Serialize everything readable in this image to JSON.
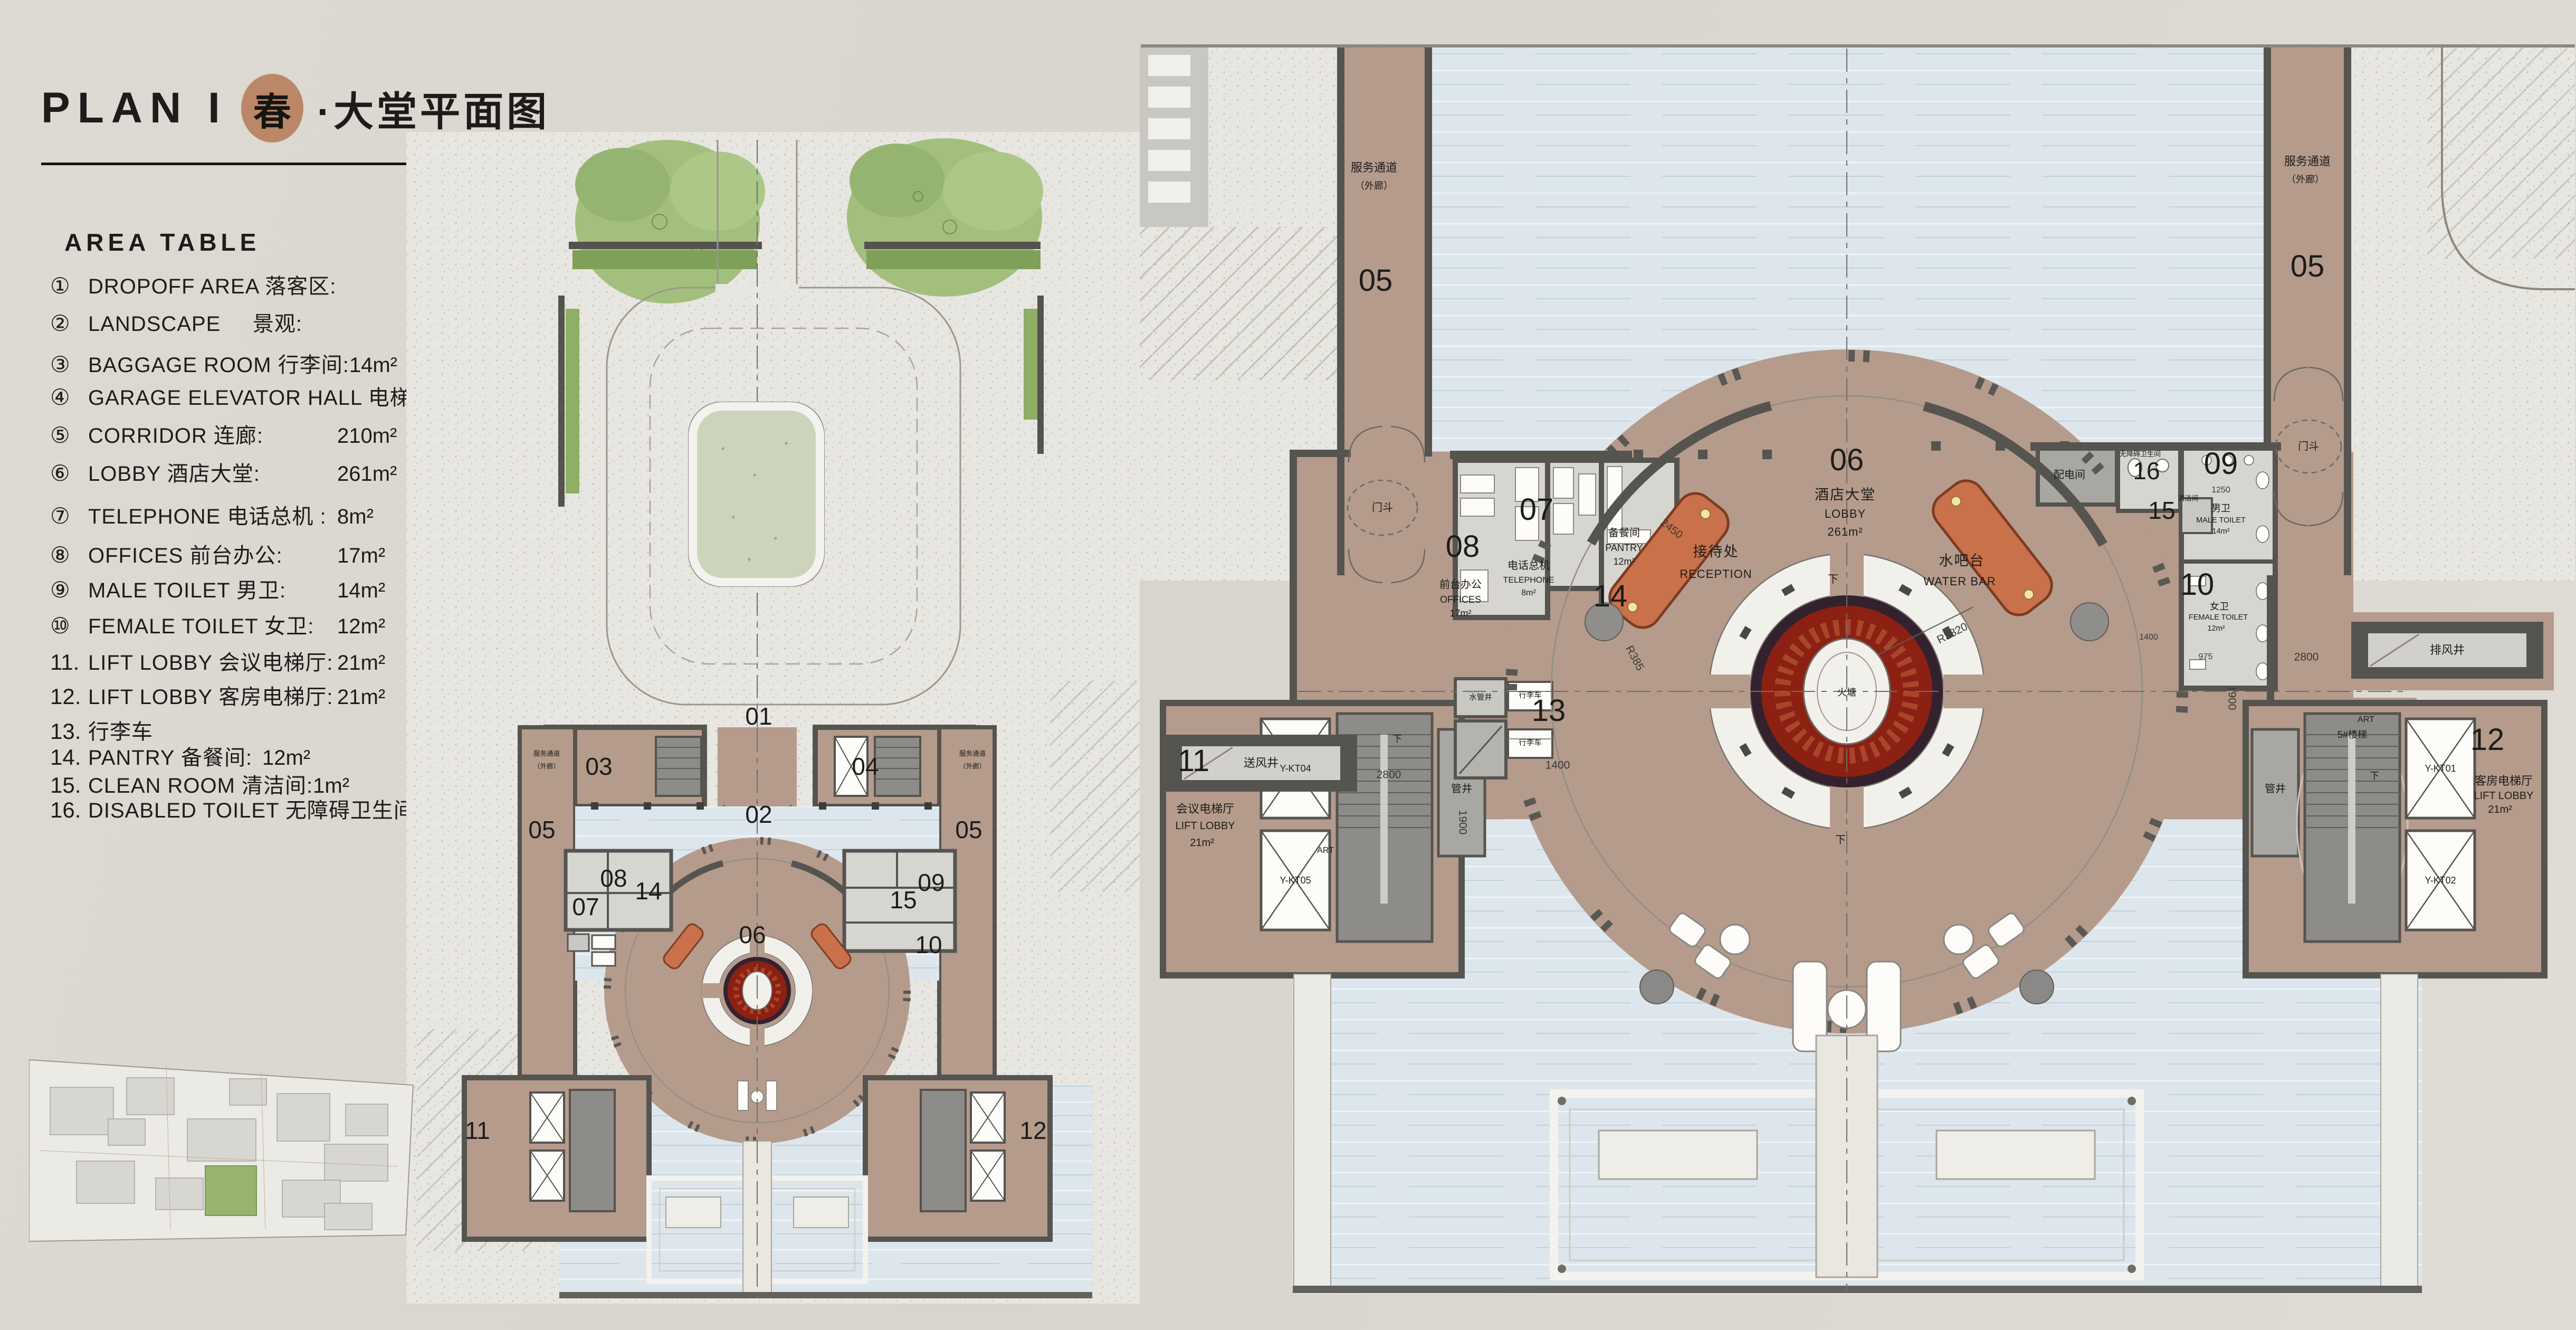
{
  "title": {
    "plan": "PLAN I",
    "season": "春",
    "rest": "·大堂平面图"
  },
  "colors": {
    "season_badge": "#bb8767",
    "carpet_red": "#8c2013",
    "floor_tan": "#b59b8c",
    "water": "#dce6ec",
    "wall_gray": "#56544f",
    "landscape_green": "#a3bf7d"
  },
  "area_table": {
    "heading": "AREA TABLE",
    "rows": [
      {
        "num": "①",
        "label": "DROPOFF AREA 落客区:",
        "area": ""
      },
      {
        "num": "②",
        "label": "LANDSCAPE     景观:",
        "area": ""
      },
      {
        "num": "③",
        "label": "BAGGAGE ROOM 行李间:",
        "area": "14m²"
      },
      {
        "num": "④",
        "label": "GARAGE ELEVATOR HALL 电梯厅:",
        "area": "11m²"
      },
      {
        "num": "⑤",
        "label": "CORRIDOR 连廊:",
        "area": "210m²"
      },
      {
        "num": "⑥",
        "label": "LOBBY 酒店大堂:",
        "area": "261m²"
      },
      {
        "num": "⑦",
        "label": "TELEPHONE 电话总机 :",
        "area": "8m²"
      },
      {
        "num": "⑧",
        "label": "OFFICES 前台办公:",
        "area": "17m²"
      },
      {
        "num": "⑨",
        "label": "MALE TOILET 男卫:",
        "area": "14m²"
      },
      {
        "num": "⑩",
        "label": "FEMALE TOILET 女卫:",
        "area": "12m²"
      },
      {
        "num": "11.",
        "label": "LIFT LOBBY 会议电梯厅:",
        "area": "21m²"
      },
      {
        "num": "12.",
        "label": "LIFT LOBBY 客房电梯厅:",
        "area": "21m²"
      },
      {
        "num": "13.",
        "label": "行李车",
        "area": ""
      },
      {
        "num": "14.",
        "label": "PANTRY 备餐间:",
        "area": "12m²"
      },
      {
        "num": "15.",
        "label": "CLEAN ROOM 清洁间:",
        "area": "1m²"
      },
      {
        "num": "16.",
        "label": "DISABLED TOILET 无障碍卫生间:",
        "area": "4.6m²"
      }
    ]
  },
  "rooms": {
    "n01": "01",
    "n02": "02",
    "n03": "03",
    "n04": "04",
    "n05": "05",
    "n06": "06",
    "n07": "07",
    "n08": "08",
    "n09": "09",
    "n10": "10",
    "n11": "11",
    "n12": "12",
    "n13": "13",
    "n14": "14",
    "n15": "15",
    "n16": "16"
  },
  "labels": {
    "svc_passage": "服务通道",
    "svc_passage_sub": "（外廊）",
    "vestibule": "门斗",
    "lobby_cn": "酒店大堂",
    "lobby_en": "LOBBY",
    "lobby_area": "261m²",
    "reception_cn": "接待处",
    "reception_en": "RECEPTION",
    "water_bar_cn": "水吧台",
    "water_bar_en": "WATER BAR",
    "fire_pit": "火塘",
    "offices_cn": "前台办公",
    "offices_en": "OFFICES",
    "offices_area": "17m²",
    "telephone_cn": "电话总机",
    "telephone_en": "TELEPHONE",
    "telephone_area": "8m²",
    "pantry_cn": "备餐间",
    "pantry_en": "PANTRY",
    "pantry_area": "12m²",
    "male_cn": "男卫",
    "male_en": "MALE TOILET",
    "male_area": "14m²",
    "female_cn": "女卫",
    "female_en": "FEMALE TOILET",
    "female_area": "12m²",
    "disabled_cn": "无障碍卫生间",
    "clean_cn": "清洁间",
    "power_room": "配电间",
    "supply_shaft": "送风井",
    "exhaust_shaft": "排风井",
    "water_shaft": "水管井",
    "pipe_shaft": "管井",
    "trolley": "行李车",
    "meeting_lift_cn": "会议电梯厅",
    "guest_lift_cn": "客房电梯厅",
    "lift_lobby_en": "LIFT LOBBY",
    "lift_area": "21m²",
    "stair5": "5#楼梯",
    "down": "下",
    "art": "ART",
    "kt01": "Y-KT01",
    "kt02": "Y-KT02",
    "kt04": "Y-KT04",
    "kt05": "Y-KT05"
  },
  "dims": {
    "d2450": "2450",
    "r385": "R385",
    "r3820": "R3820",
    "d2800": "2800",
    "d1900": "1900",
    "d1400": "1400",
    "d1250": "1250",
    "d975": "975"
  }
}
